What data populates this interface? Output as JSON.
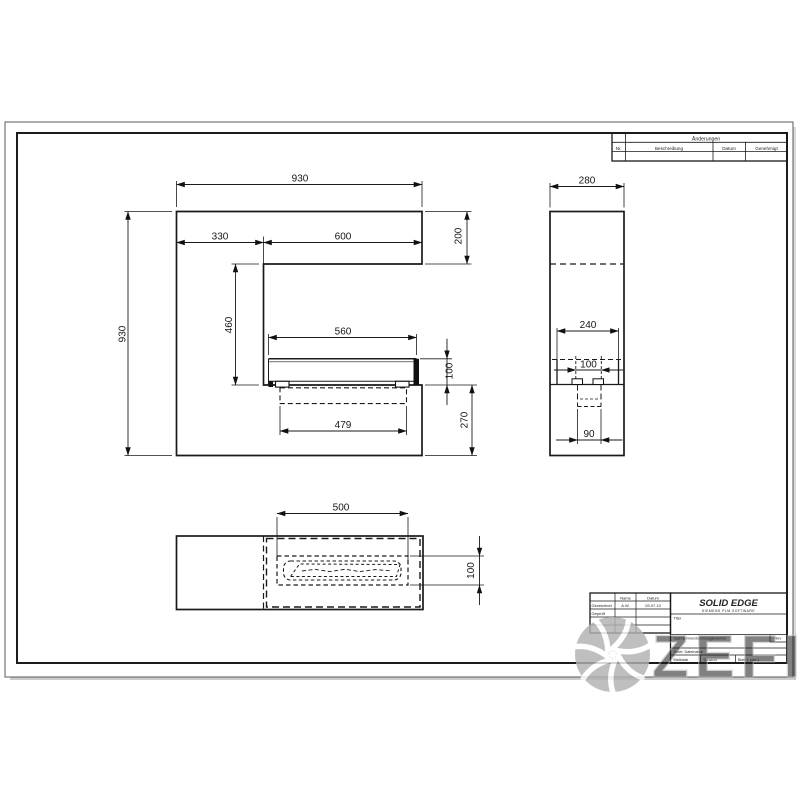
{
  "watermark": {
    "text": "ZEFIRE"
  },
  "revision_table": {
    "header": "Änderungen",
    "col_nr": "Nr.",
    "col_desc": "Beschreibung",
    "col_date": "Datum",
    "col_approved": "Genehmigt"
  },
  "title_block": {
    "col_name": "Name",
    "col_date": "Datum",
    "row1_label": "Gezeichnet",
    "row1_name": "A.W.",
    "row1_date": "03.07.13",
    "row2_label": "Geprüft",
    "app_name": "SOLID EDGE",
    "app_sub": "SIEMENS PLM SOFTWARE",
    "title_label": "Titel",
    "docnum_label": "Sachnummer/Zeichnungsnummer",
    "rev_label": "Rev",
    "file_label": "Datei: Dateiname",
    "scale_label": "Maßstab",
    "weight_label": "Gewicht",
    "sheet_label": "Blatt 1 von 1"
  },
  "views": {
    "front": {
      "dims": {
        "overall_width": "930",
        "overall_height": "930",
        "left_column": "330",
        "opening_width": "600",
        "top_bar_height": "200",
        "opening_height": "460",
        "burner_width": "560",
        "burner_height": "100",
        "tank_width": "479",
        "bottom_height": "270"
      }
    },
    "side": {
      "dims": {
        "depth": "280",
        "box_depth": "240",
        "slot_width": "100",
        "tank_depth": "90"
      }
    },
    "plan": {
      "dims": {
        "insert_width": "500",
        "slot_depth": "100"
      }
    }
  }
}
